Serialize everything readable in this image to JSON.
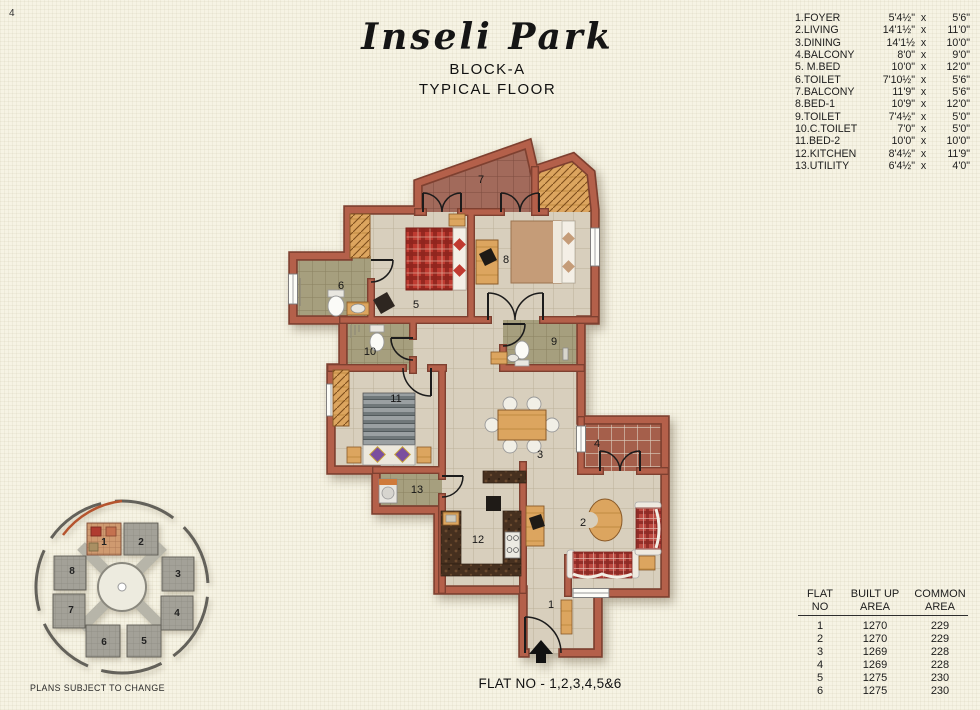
{
  "page": {
    "number": "4",
    "footnote": "PLANS SUBJECT TO CHANGE",
    "caption": "FLAT NO - 1,2,3,4,5&6"
  },
  "title": {
    "project": "Inseli Park",
    "block": "BLOCK-A",
    "floor": "TYPICAL FLOOR"
  },
  "room_list": [
    {
      "name": "1.FOYER",
      "w": "5'4½\"",
      "x": "x",
      "h": "5'6\""
    },
    {
      "name": "2.LIVING",
      "w": "14'1½\"",
      "x": "x",
      "h": "11'0\""
    },
    {
      "name": "3.DINING",
      "w": "14'1½",
      "x": "x",
      "h": "10'0\""
    },
    {
      "name": "4.BALCONY",
      "w": "8'0\"",
      "x": "x",
      "h": "9'0\""
    },
    {
      "name": "5. M.BED",
      "w": "10'0\"",
      "x": "x",
      "h": "12'0\""
    },
    {
      "name": "6.TOILET",
      "w": "7'10½\"",
      "x": "x",
      "h": "5'6\""
    },
    {
      "name": "7.BALCONY",
      "w": "11'9\"",
      "x": "x",
      "h": "5'6\""
    },
    {
      "name": "8.BED-1",
      "w": "10'9\"",
      "x": "x",
      "h": "12'0\""
    },
    {
      "name": "9.TOILET",
      "w": "7'4½\"",
      "x": "x",
      "h": "5'0\""
    },
    {
      "name": "10.C.TOILET",
      "w": "7'0\"",
      "x": "x",
      "h": "5'0\""
    },
    {
      "name": "11.BED-2",
      "w": "10'0\"",
      "x": "x",
      "h": "10'0\""
    },
    {
      "name": "12.KITCHEN",
      "w": "8'4½\"",
      "x": "x",
      "h": "11'9\""
    },
    {
      "name": "13.UTILITY",
      "w": "6'4½\"",
      "x": "x",
      "h": "4'0\""
    }
  ],
  "area_table": {
    "col1": [
      "FLAT",
      "NO"
    ],
    "col2": [
      "BUILT UP",
      "AREA"
    ],
    "col3": [
      "COMMON",
      "AREA"
    ],
    "rows": [
      {
        "flat": "1",
        "built": "1270",
        "common": "229"
      },
      {
        "flat": "2",
        "built": "1270",
        "common": "229"
      },
      {
        "flat": "3",
        "built": "1269",
        "common": "228"
      },
      {
        "flat": "4",
        "built": "1269",
        "common": "228"
      },
      {
        "flat": "5",
        "built": "1275",
        "common": "230"
      },
      {
        "flat": "6",
        "built": "1275",
        "common": "230"
      }
    ]
  },
  "plan_labels": {
    "1": "1",
    "2": "2",
    "3": "3",
    "4": "4",
    "5": "5",
    "6": "6",
    "7": "7",
    "8": "8",
    "9": "9",
    "10": "10",
    "11": "11",
    "12": "12",
    "13": "13"
  },
  "keyplan_labels": {
    "1": "1",
    "2": "2",
    "3": "3",
    "4": "4",
    "5": "5",
    "6": "6",
    "7": "7",
    "8": "8"
  },
  "colors": {
    "wall": "#b4604a",
    "wall_edge": "#7e4030",
    "floor": "#d8cfbd",
    "toilet_floor": "#a69f7e",
    "balcony_floor": "#a2695a",
    "wood": "#dca55f",
    "background": "#f6f3e4",
    "accent_red": "#c0392e"
  }
}
